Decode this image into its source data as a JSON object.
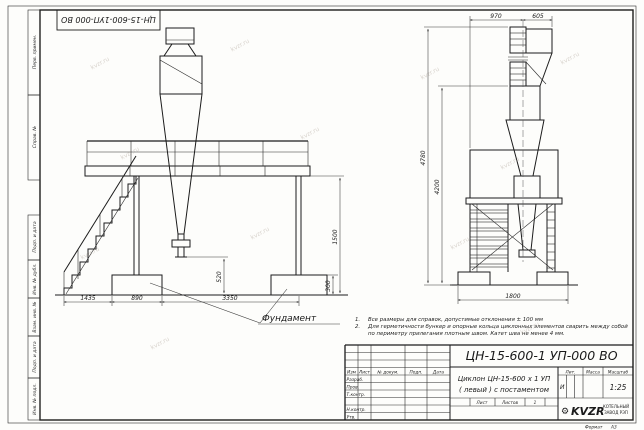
{
  "sheet": {
    "format_label": "Формат",
    "format_value": "А3",
    "watermark": "kvzr.ru"
  },
  "margin_stamps": {
    "top_designation": "ЦН-15-600-1УП-000  ВО",
    "col1": "Перв. примен.",
    "col2": "Справ. №",
    "col3": "Подп. и дата",
    "col4": "Инв. № дубл.",
    "col5": "Взам. инв. №",
    "col6": "Подп. и дата",
    "col7": "Инв. № подл."
  },
  "notes": {
    "n1_num": "1.",
    "n1_text": "Все размеры для справок, допустимые отклонения ± 100 мм",
    "n2_num": "2.",
    "n2_text": "Для герметичности бункер и опорные кольца циклонных элементов сварить между собой по периметру прилегания плотным швом. Катет шва не менее 4 мм."
  },
  "title_block": {
    "designation": "ЦН-15-600-1 УП-000  ВО",
    "name_line1": "Циклон ЦН-15-600 х 1 УП",
    "name_line2": "( левый )  с постаментом",
    "rev_col_izm": "Изм",
    "rev_col_list": "Лист",
    "rev_col_doc": "№ докум.",
    "rev_col_sign": "Подп.",
    "rev_col_date": "Дата",
    "row_razrab": "Разраб.",
    "row_prov": "Пров.",
    "row_tkontr": "Т.контр.",
    "row_nkontr": "Н.контр.",
    "row_utv": "Утв.",
    "lit_header": "Лит.",
    "mass_header": "Масса",
    "scale_header": "Масштаб",
    "lit_value": "И",
    "scale_value": "1:25",
    "sheet_label": "Лист",
    "sheets_label": "Листов",
    "sheets_value": "1",
    "logo_gear": "⚙",
    "logo_text": "KVZR",
    "company_line1": "КОТЕЛЬНЫЙ",
    "company_line2": "ЗАВОД РЭП"
  },
  "drawing": {
    "foundation_label": "Фундамент",
    "dims": {
      "stairs_run": "1435",
      "foundation_width": "890",
      "foundation_spacing": "3350",
      "outlet_height": "520",
      "foundation_height": "300",
      "platform_height": "1500",
      "inlet_offset_left": "970",
      "inlet_offset_right": "605",
      "total_height": "4780",
      "cyclone_height": "4200",
      "postament_width": "1800"
    }
  }
}
